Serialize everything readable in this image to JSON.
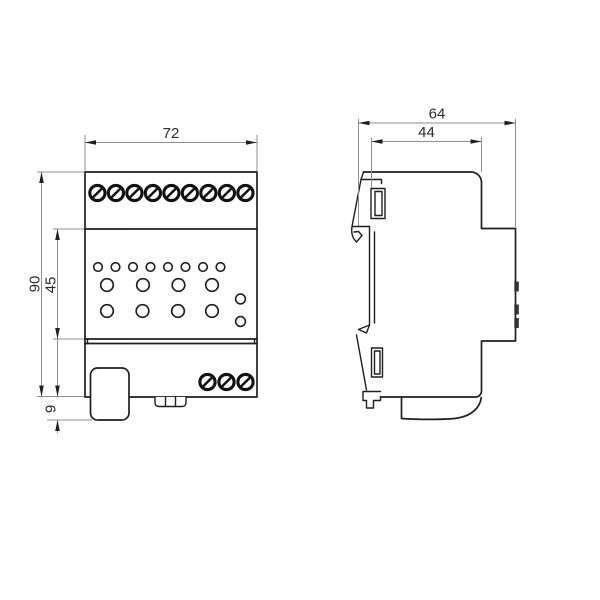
{
  "front_view": {
    "width_label": "72",
    "height_label": "90",
    "mid_height_label": "45",
    "foot_height_label": "9",
    "top_terminal_count": 9,
    "bottom_terminal_count": 3,
    "small_led_count": 8,
    "button_count": 8,
    "aux_indicator_count": 2
  },
  "side_view": {
    "total_depth_label": "64",
    "front_depth_label": "44",
    "front_tab_count": 3
  },
  "colors": {
    "outline": "#1f1f1f",
    "dimension_line": "#8f8f8f",
    "label_text": "#2b2b2b",
    "background": "#ffffff"
  }
}
